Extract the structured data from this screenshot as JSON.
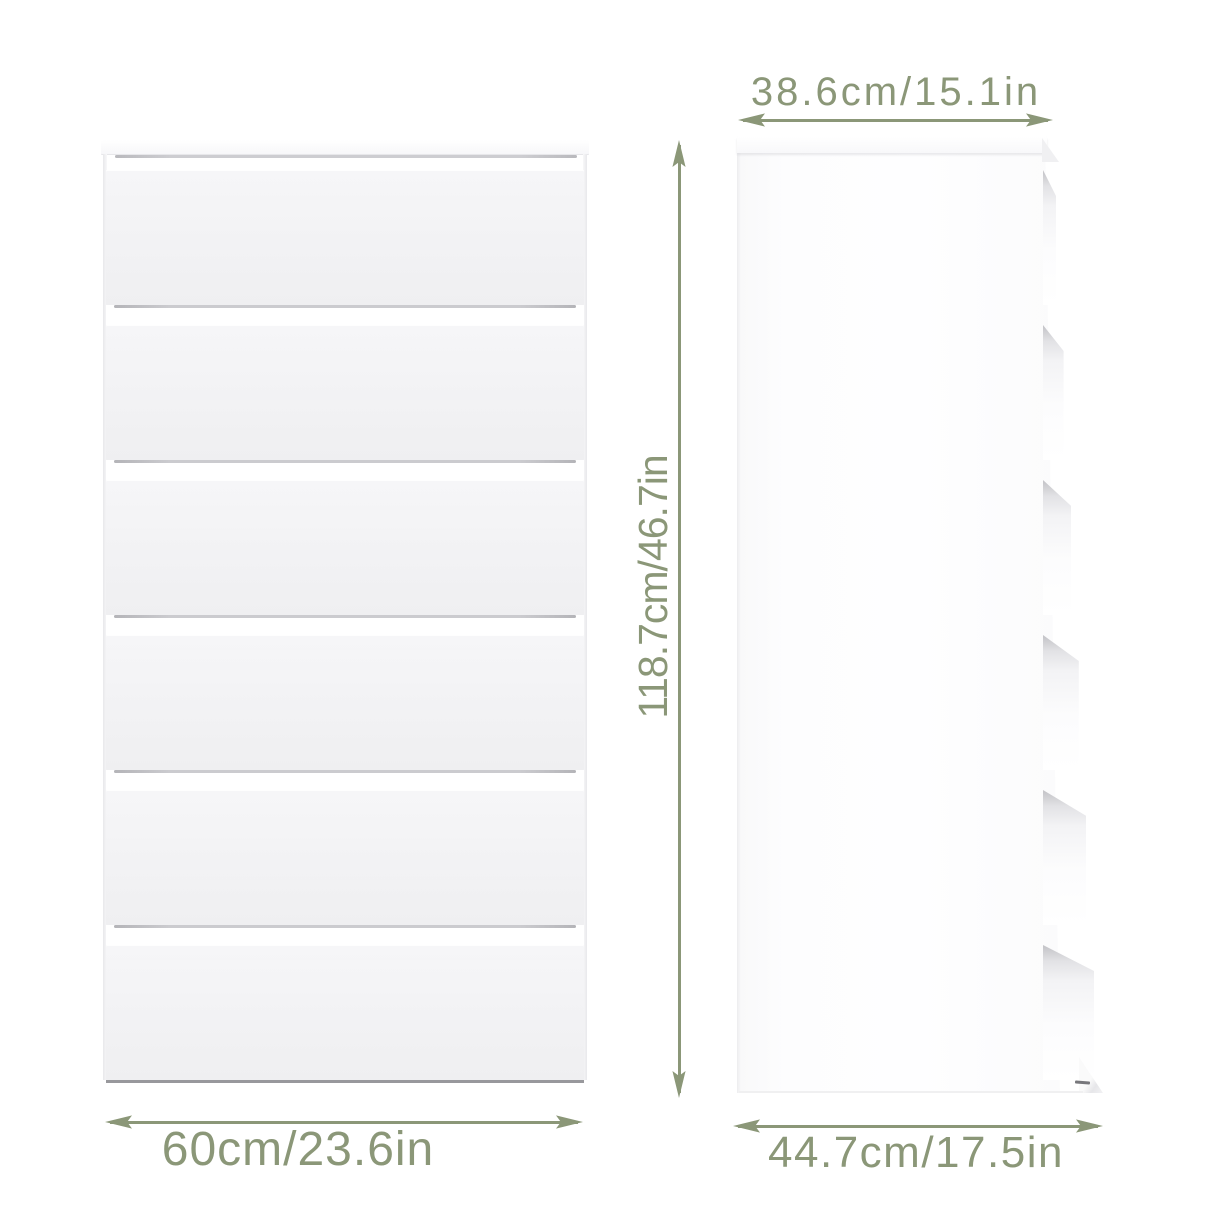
{
  "page": {
    "background_color": "#ffffff",
    "accent_color": "#8b9778",
    "description": "Product dimension diagram of a white chest of drawers shown in front view and side view"
  },
  "furniture": {
    "type": "chest of drawers",
    "drawer_count": 6,
    "body_color": "#ffffff",
    "drawer_face_color": "#f3f3f5"
  },
  "dimensions": {
    "side_width": "38.6cm/15.1in",
    "height": "118.7cm/46.7in",
    "front_width": "60cm/23.6in",
    "depth": "44.7cm/17.5in"
  }
}
